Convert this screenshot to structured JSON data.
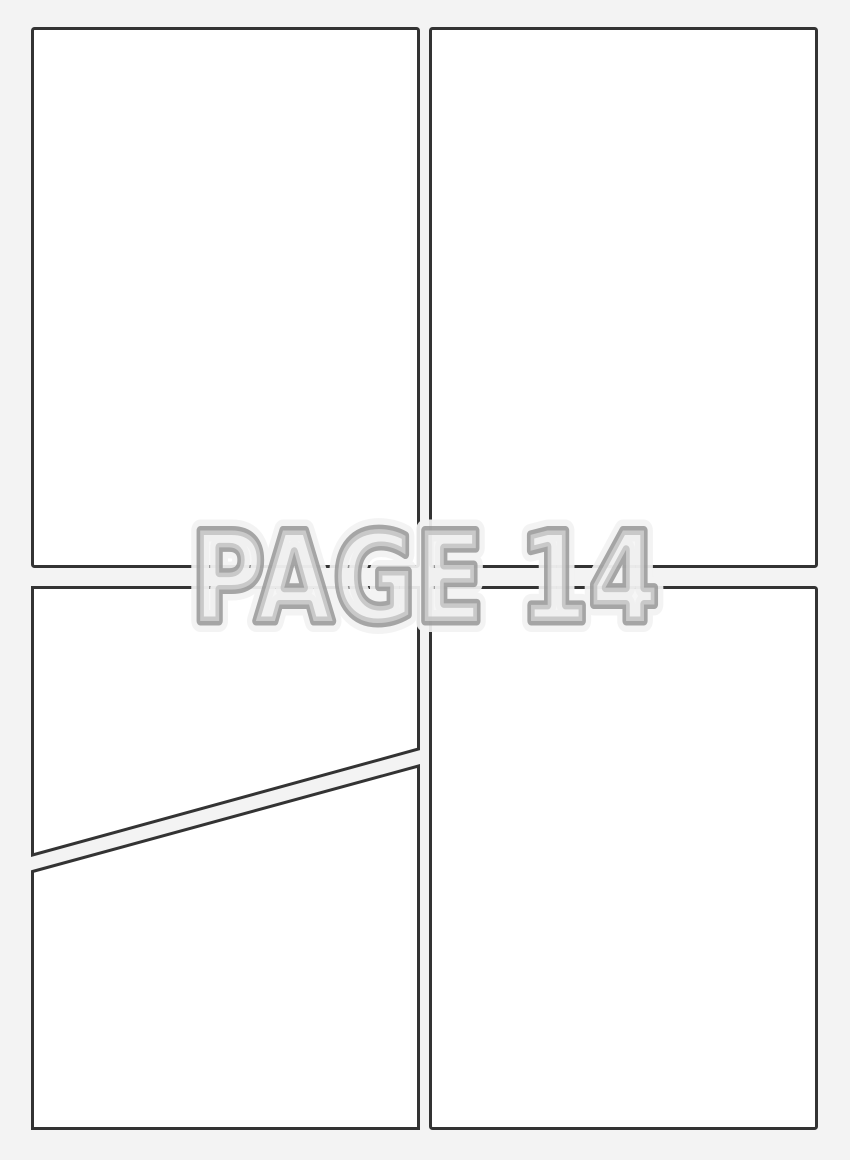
{
  "watermark": {
    "text": "PAGE 14"
  },
  "colors": {
    "background": "#f3f3f3",
    "panel_fill": "#ffffff",
    "panel_border": "#333333",
    "watermark_fill": "#ededed",
    "watermark_outline": "#979797"
  }
}
